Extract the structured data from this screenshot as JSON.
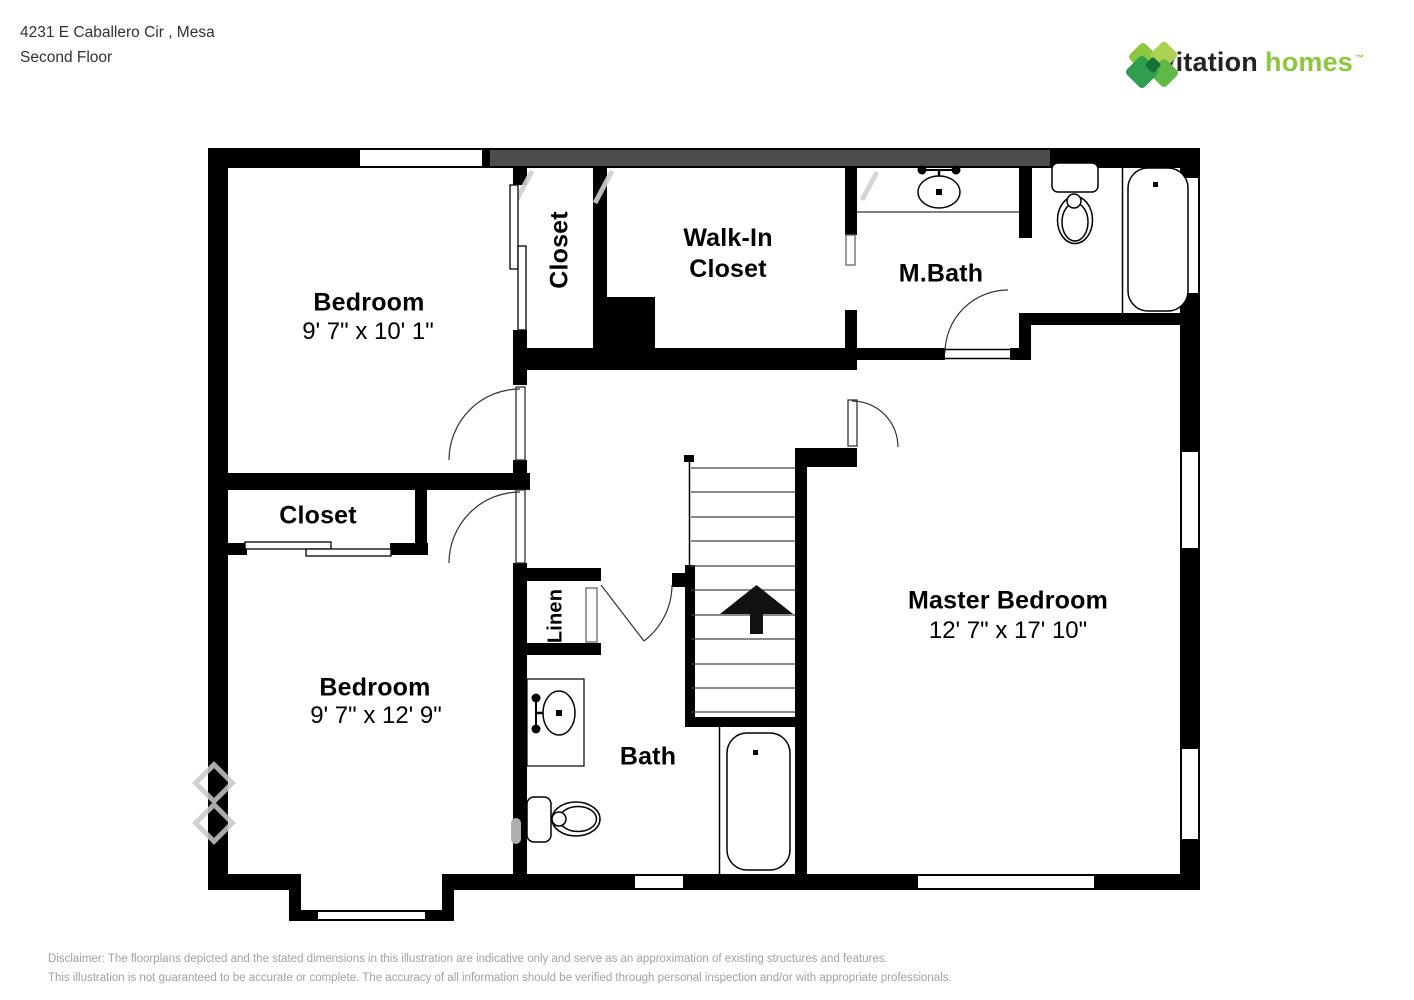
{
  "header": {
    "address_line1": "4231 E Caballero Cir , Mesa",
    "address_line2": "Second Floor"
  },
  "logo": {
    "word_dark": "invitation",
    "word_green": "homes",
    "trademark": "™",
    "icon": "invitation-homes-diamond-logo",
    "colors": {
      "dark_text": "#262226",
      "green_text": "#8dc63f",
      "diamond_greens": [
        "#8dc63f",
        "#abd155",
        "#2f9e4e",
        "#62b846",
        "#17703a"
      ]
    }
  },
  "floorplan": {
    "wall_color": "#000000",
    "stairs_direction": "up",
    "icons": [
      "sink-icon",
      "toilet-icon",
      "bathtub-icon",
      "stairs-up-arrow-icon",
      "door-arc",
      "window",
      "sliding-door"
    ],
    "rooms": [
      {
        "id": "bedroom-1",
        "label": "Bedroom",
        "dims": "9' 7\" x 10' 1\""
      },
      {
        "id": "closet-tall",
        "label": "Closet"
      },
      {
        "id": "walk-in-closet",
        "label": "Walk-In Closet"
      },
      {
        "id": "master-bath",
        "label": "M.Bath"
      },
      {
        "id": "closet-small",
        "label": "Closet"
      },
      {
        "id": "bedroom-2",
        "label": "Bedroom",
        "dims": "9' 7\" x 12' 9\""
      },
      {
        "id": "linen",
        "label": "Linen"
      },
      {
        "id": "bath",
        "label": "Bath"
      },
      {
        "id": "master-bedroom",
        "label": "Master Bedroom",
        "dims": "12' 7\" x 17' 10\""
      }
    ]
  },
  "footer": {
    "text_color": "#a2a2a2",
    "disclaimer_line1": "Disclaimer: The floorplans depicted and the stated dimensions in this illustration are indicative only and serve as an approximation of existing structures and features.",
    "disclaimer_line2": "This illustration is not guaranteed to be accurate or complete. The accuracy of all information should be verified through personal inspection and/or with appropriate professionals."
  }
}
